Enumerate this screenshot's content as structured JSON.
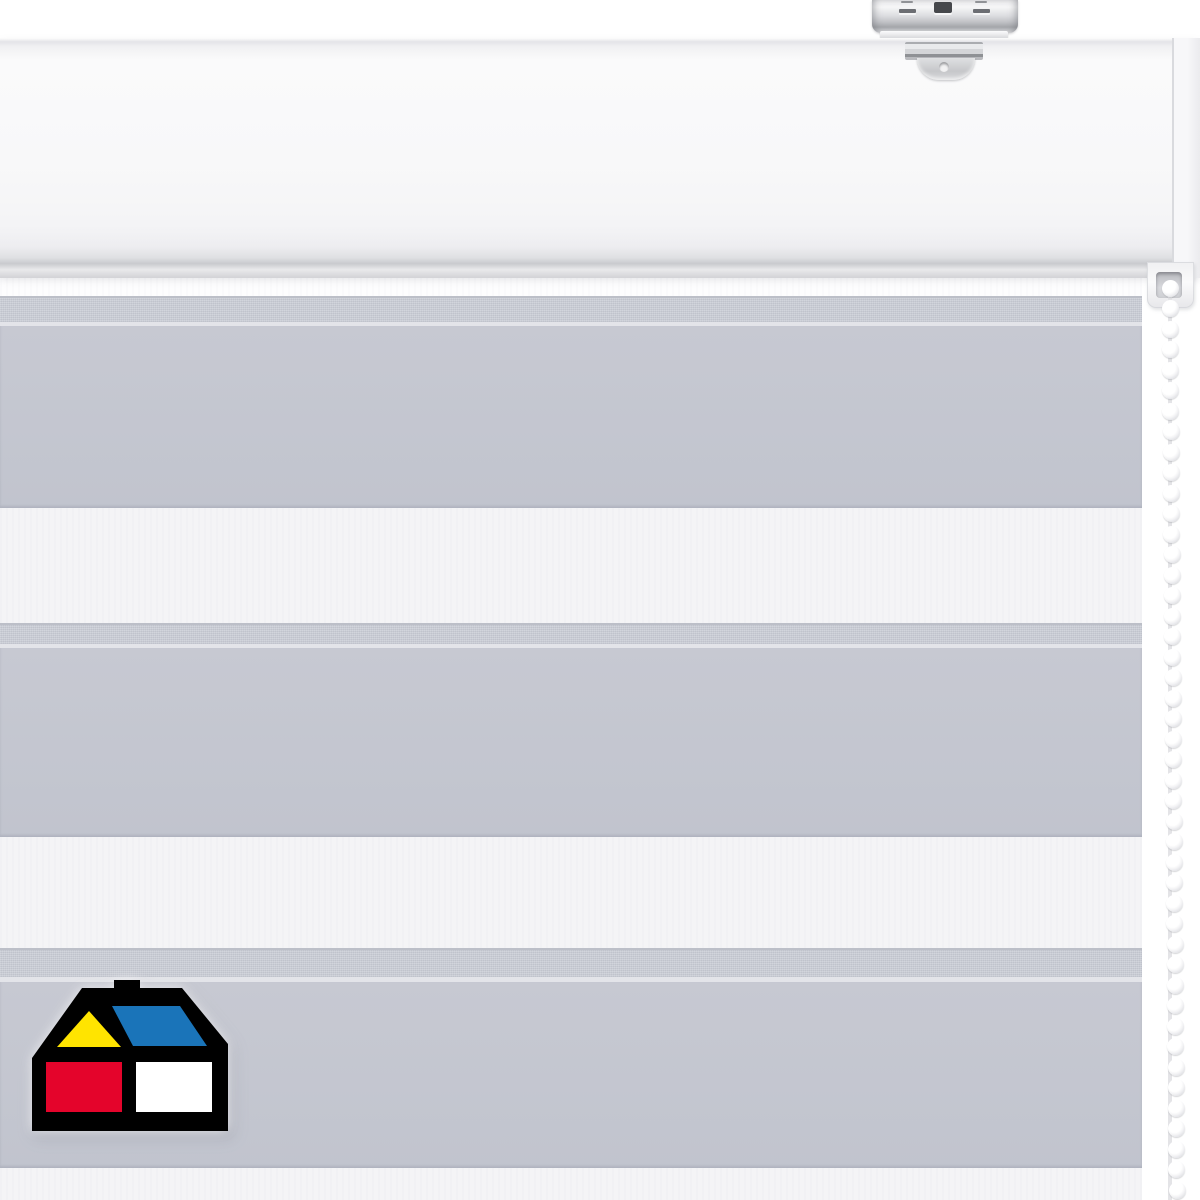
{
  "scene": {
    "width": 1200,
    "height": 1200,
    "background": "#ffffff"
  },
  "product": {
    "subject": "day-night-zebra-roller-blind",
    "fabric_stripes": [
      "gray",
      "white"
    ],
    "hardware_finish": "white"
  },
  "headrail": {
    "y": 38,
    "h": 240,
    "endcap_x": 1172,
    "endcap_w": 28
  },
  "bracket": {
    "plate": {
      "x": 872,
      "y": 0,
      "w": 146,
      "h": 33
    },
    "lip": {
      "x": 880,
      "y": 31,
      "w": 128,
      "h": 8
    },
    "clamp_bar": {
      "x": 905,
      "y": 42,
      "w": 78,
      "h": 18
    },
    "clamp_tab": {
      "x": 917,
      "y": 58,
      "w": 58,
      "h": 22
    },
    "screw_hole": {
      "cx": 944,
      "cy": 67,
      "r": 5
    },
    "slot_center": {
      "x": 934,
      "y": 2,
      "w": 18,
      "h": 11
    },
    "stamp_left": {
      "x": 899,
      "y": 9,
      "w": 17,
      "h": 4
    },
    "stamp_right": {
      "x": 973,
      "y": 9,
      "w": 17,
      "h": 4
    },
    "dash_left": {
      "x": 901,
      "y": 1,
      "w": 12,
      "h": 2
    },
    "dash_right": {
      "x": 975,
      "y": 1,
      "w": 12,
      "h": 2
    }
  },
  "fabric": {
    "x": 0,
    "y": 278,
    "w": 1142,
    "h": 922,
    "colors": {
      "gray": "#c7c9d2",
      "gray_deep": "#c1c4ce",
      "edge": "#cbced6",
      "edge_line": "#bcbfc8",
      "seam": "#e3e4e9",
      "white": "#f4f4f6",
      "white_bright": "#fdfdfe"
    },
    "bands": [
      {
        "kind": "white-gap",
        "y": 278,
        "h": 18
      },
      {
        "kind": "edge",
        "y": 296,
        "h": 26
      },
      {
        "kind": "seam",
        "y": 322,
        "h": 4
      },
      {
        "kind": "gray",
        "y": 326,
        "h": 182
      },
      {
        "kind": "white",
        "y": 508,
        "h": 115
      },
      {
        "kind": "edge",
        "y": 623,
        "h": 21
      },
      {
        "kind": "seam",
        "y": 644,
        "h": 4
      },
      {
        "kind": "gray",
        "y": 648,
        "h": 189
      },
      {
        "kind": "white",
        "y": 837,
        "h": 111
      },
      {
        "kind": "edge",
        "y": 948,
        "h": 29
      },
      {
        "kind": "seam",
        "y": 977,
        "h": 5
      },
      {
        "kind": "gray",
        "y": 982,
        "h": 186
      },
      {
        "kind": "white",
        "y": 1168,
        "h": 32
      }
    ]
  },
  "chain": {
    "guide": {
      "x": 1147,
      "y": 262,
      "w": 47,
      "h": 46
    },
    "guide_hole": {
      "x": 1156,
      "y": 272,
      "w": 26,
      "h": 26
    },
    "first_y": 288,
    "last_y": 1205,
    "spacing": 20.5,
    "bead_d": 17,
    "cx_top": 1170,
    "cx_bottom": 1177,
    "cord_color": "#e4e4e7"
  },
  "logo": {
    "x": 32,
    "y": 978,
    "w": 196,
    "h": 153,
    "colors": {
      "outline": "#000000",
      "gable": "#ffe400",
      "roof": "#1a74b9",
      "square_left": "#e4042b",
      "square_right": "#ffffff"
    }
  }
}
